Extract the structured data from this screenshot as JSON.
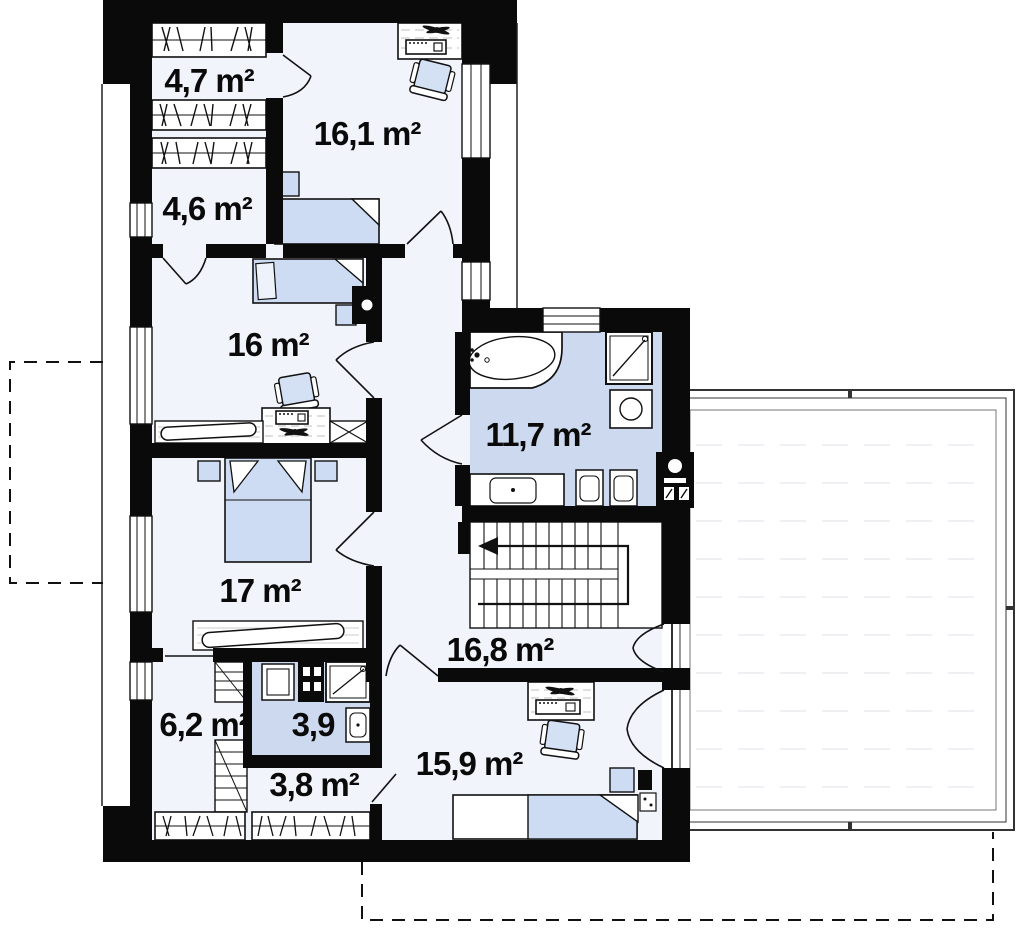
{
  "plan": {
    "title": "Floor plan",
    "unit": "m²",
    "rooms": [
      {
        "key": "closet_top",
        "label": "4,7 m²"
      },
      {
        "key": "bedroom_top",
        "label": "16,1 m²"
      },
      {
        "key": "closet_upper",
        "label": "4,6 m²"
      },
      {
        "key": "bedroom_mid",
        "label": "16 m²"
      },
      {
        "key": "bathroom",
        "label": "11,7 m²"
      },
      {
        "key": "bedroom_low",
        "label": "17 m²"
      },
      {
        "key": "hallway",
        "label": "16,8 m²"
      },
      {
        "key": "wardrobe",
        "label": "6,2 m²"
      },
      {
        "key": "wc",
        "label": "3,9"
      },
      {
        "key": "closet_bottom",
        "label": "3,8 m²"
      },
      {
        "key": "bedroom_bottom",
        "label": "15,9 m²"
      }
    ],
    "colors": {
      "wall": "#0a0a0a",
      "floor": "#f1f4fb",
      "wet_floor": "#ccd9ee",
      "furniture_blue": "#cddcf2",
      "line": "#111111",
      "terrace_line": "#333333"
    }
  }
}
